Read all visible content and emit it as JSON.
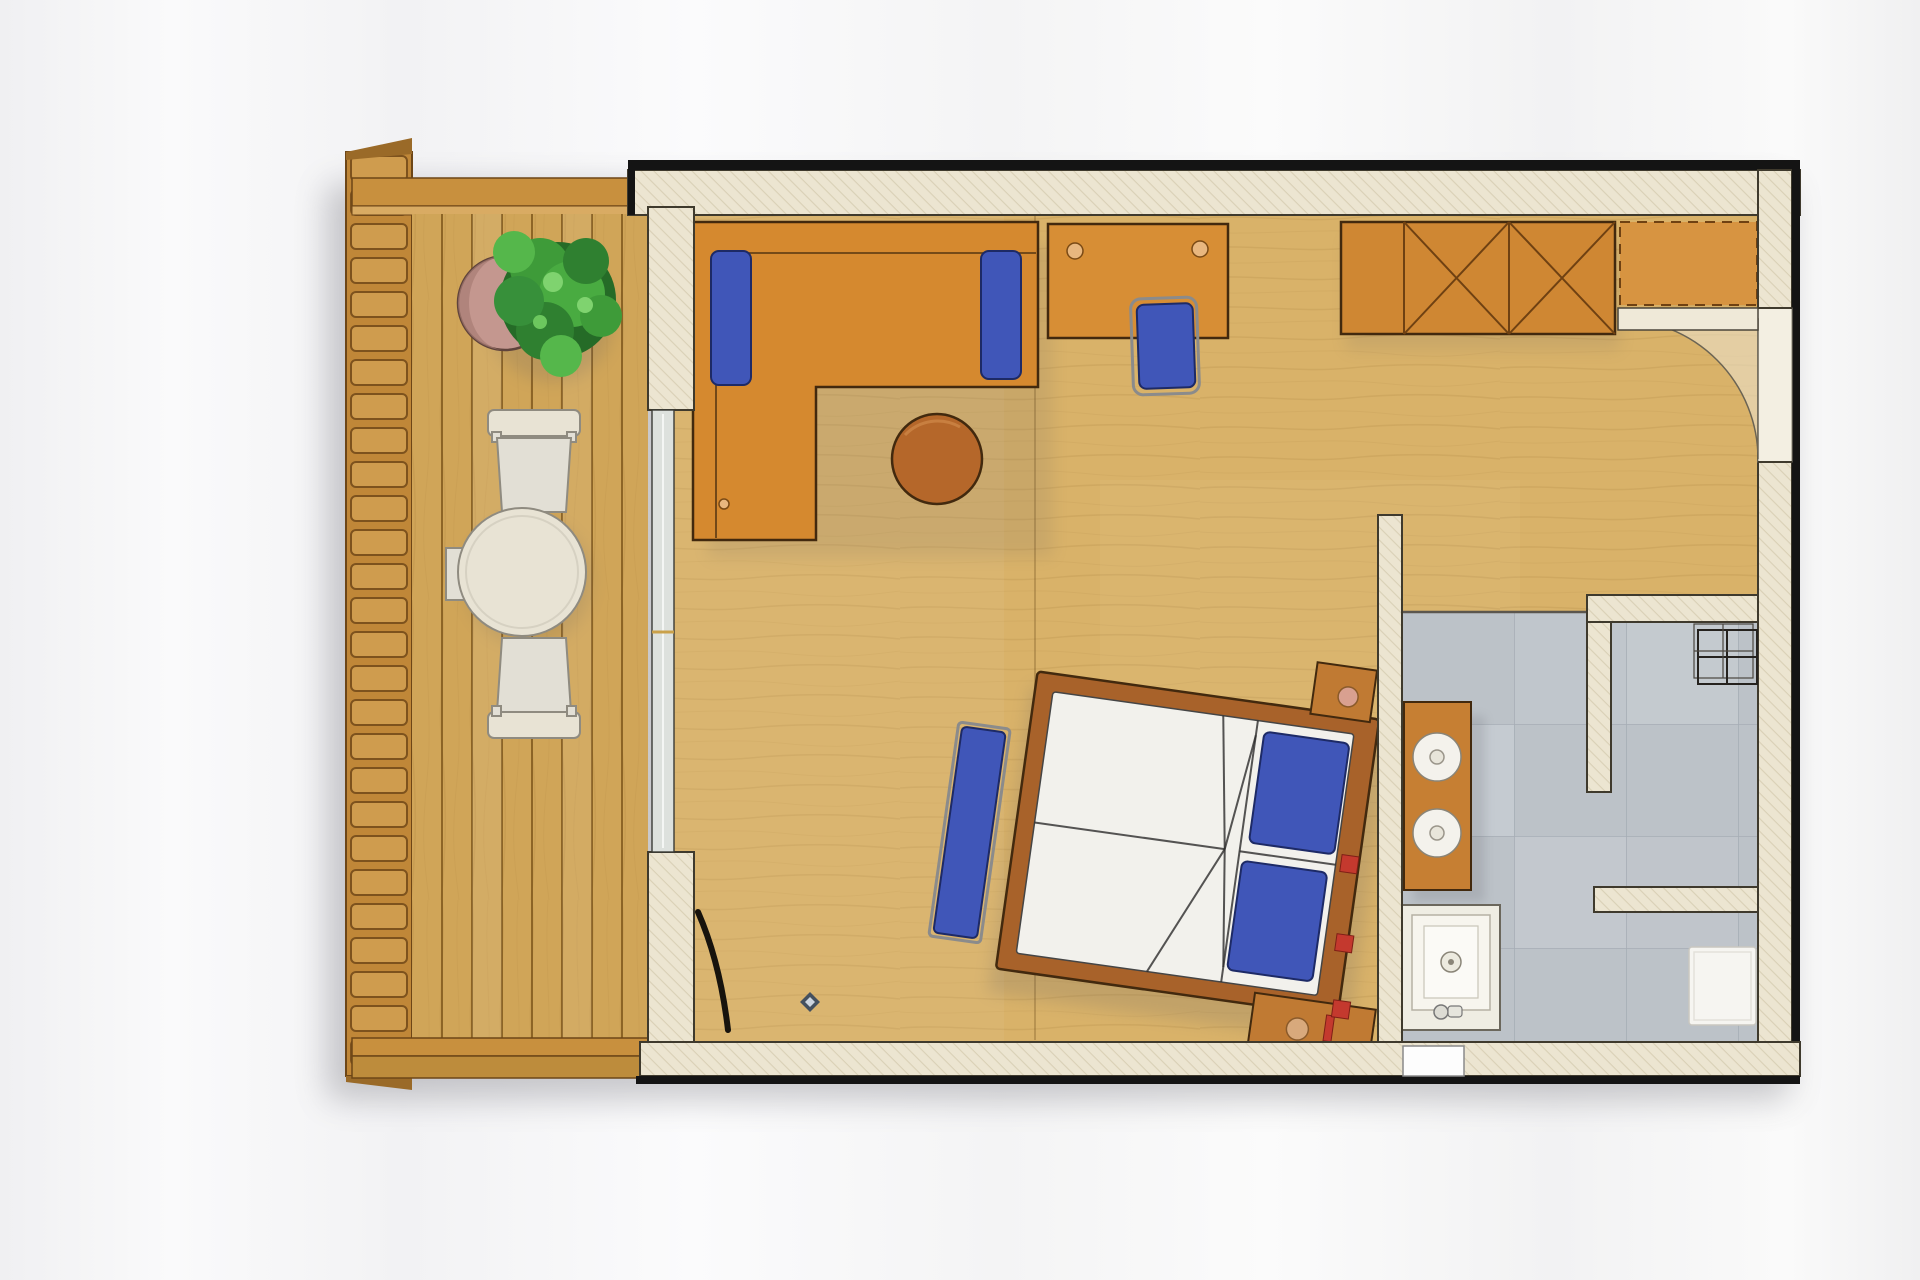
{
  "scene": {
    "type": "architectural-floor-plan",
    "view": "top-down",
    "subject": "studio apartment with balcony, living-sleeping area, bathroom and entry",
    "visible_text": []
  },
  "palette": {
    "background": "#f5f5f6",
    "drop_shadow": "#5a5a64",
    "ink": "#141414",
    "wall_fill": "#ece5d1",
    "wall_hatch": "#d9d0b6",
    "wall_outline": "#3f3a2d",
    "door_leaf": "#efe9d8",
    "door_arc_fill": "rgba(236,229,211,0.55)",
    "glass": "#dde1dd",
    "glass_edge": "#3a3a35",
    "louver_base": "#c08738",
    "louver_slat": "#cf9c4e",
    "louver_line": "#7d521d",
    "wood_frame": "#c8903e",
    "wood_frame_dark": "#6d4617",
    "deck": "#d0a558",
    "deck_gap": "#8d6526",
    "floor_wood": "#d9b269",
    "floor_grain": "rgba(125,85,25,0.2)",
    "tile": "#bcc2c8",
    "tile_line": "#a6adb5",
    "tile_light": "#c9ced4",
    "sofa": "#d5892f",
    "desk": "#d78e35",
    "wardrobe": "#cf8733",
    "wardrobe_line": "#6f4112",
    "bench_top": "#d79441",
    "ottoman": "#b5672a",
    "furniture_outline": "#42290e",
    "accent_blue": "#4056b8",
    "accent_blue_dark": "#1d2a66",
    "chrome": "#8b8b8b",
    "bed_frame": "#a8622a",
    "mattress": "#f2f1ec",
    "seam": "#2c2c2c",
    "nightstand": "#c07a33",
    "knob_pink": "#d9a090",
    "knob_tan": "#d8a97c",
    "accent_red": "#c4392e",
    "vanity": "#c67f33",
    "basin": "#f4f2ec",
    "fixture_outline": "#6b675c",
    "shower_pan": "#efede3",
    "mat": "#f6f5f1",
    "rack": "#25221e",
    "patio_cream": "#e8e3d4",
    "patio_outline": "#8f8b80",
    "plant_dark": "#256b27",
    "plant_mid": "#3e9b39",
    "plant_light": "#55b74b",
    "pot": "#c4978f",
    "pot_rim": "#5f433c"
  },
  "areas": {
    "balcony": {
      "deck_planks": 8,
      "louver_slats": 27,
      "furniture": [
        "potted-plant",
        "bistro-table",
        "patio-chair-top",
        "patio-chair-bottom",
        "side-tray"
      ]
    },
    "living_area": {
      "furniture": [
        "l-shaped-sofa",
        "sofa-bolster-left",
        "sofa-bolster-right",
        "round-ottoman",
        "wall-desk",
        "desk-chair",
        "wardrobe",
        "luggage-bench"
      ],
      "wardrobe_x_panels": 2,
      "decor": [
        "floor-ornament",
        "leaning-object"
      ]
    },
    "sleeping_area": {
      "bed_rotation_deg": 8,
      "furniture": [
        "double-bed",
        "pillow-upper",
        "pillow-lower",
        "foot-bench",
        "nightstand-upper",
        "nightstand-lower"
      ],
      "decor_red_accents": 3
    },
    "bathroom": {
      "fixtures": [
        "vanity-counter",
        "round-basin-1",
        "round-basin-2",
        "shower-tray",
        "wire-shelf-rack",
        "bath-mat",
        "bottom-wall-window"
      ]
    },
    "entry": {
      "features": [
        "entrance-door-leaf",
        "door-swing-arc"
      ]
    }
  }
}
